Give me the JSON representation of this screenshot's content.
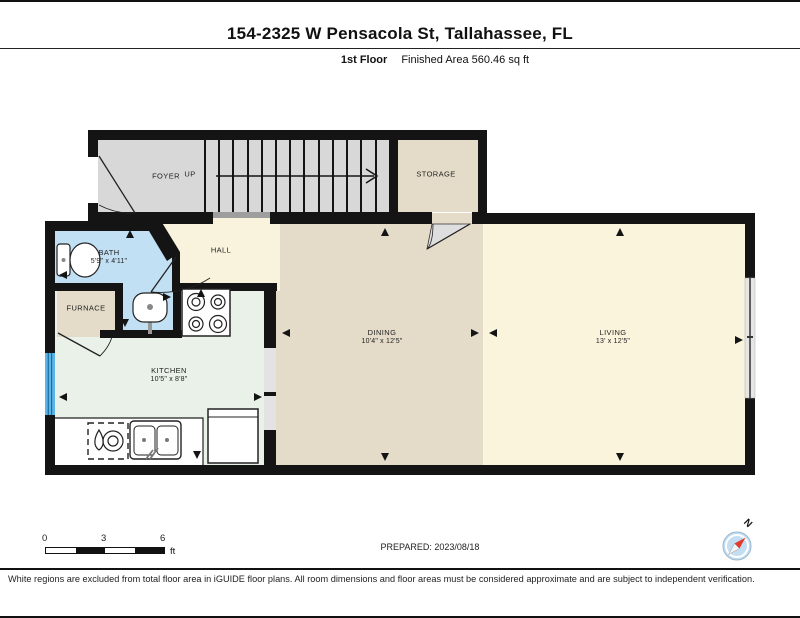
{
  "header": {
    "title": "154-2325 W Pensacola St, Tallahassee, FL",
    "floor_label": "1st Floor",
    "finished_area": "Finished Area 560.46 sq ft"
  },
  "rooms": {
    "foyer": {
      "name": "FOYER"
    },
    "stairs": {
      "direction": "UP"
    },
    "storage": {
      "name": "STORAGE"
    },
    "hall": {
      "name": "HALL"
    },
    "bath": {
      "name": "BATH",
      "dims": "5'9\" x 4'11\""
    },
    "furnace": {
      "name": "FURNACE"
    },
    "kitchen": {
      "name": "KITCHEN",
      "dims": "10'5\" x 8'8\""
    },
    "dining": {
      "name": "DINING",
      "dims": "10'4\" x 12'5\""
    },
    "living": {
      "name": "LIVING",
      "dims": "13' x 12'5\""
    }
  },
  "scale_bar": {
    "ticks": [
      "0",
      "3",
      "6"
    ],
    "unit": "ft"
  },
  "prepared": "PREPARED: 2023/08/18",
  "compass": {
    "label": "N"
  },
  "footer": "White regions are excluded from total floor area in iGUIDE floor plans. All room dimensions and floor areas must be considered approximate and are subject to independent verification.",
  "colors": {
    "wall": "#141414",
    "floor_gray": "#d8d8d8",
    "floor_tan": "#e4dcc9",
    "floor_cream": "#f9f3dd",
    "floor_blue_bath": "#c2e0f4",
    "floor_mint_kitchen": "#e9f1e8",
    "window_blue": "#5cb5e6",
    "compass_red": "#e23b30",
    "compass_blue": "#c3def2"
  }
}
